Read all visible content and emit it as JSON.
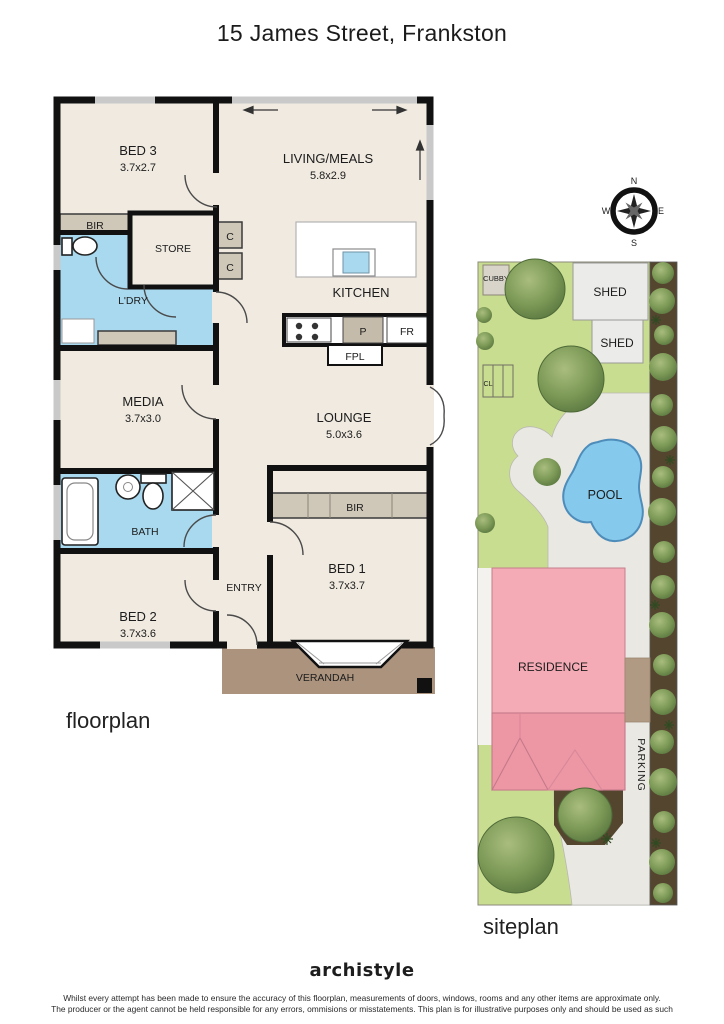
{
  "title": "15 James Street, Frankston",
  "floorplan": {
    "caption": "floorplan",
    "rooms": {
      "bed3": {
        "name": "BED 3",
        "dims": "3.7x2.7"
      },
      "living": {
        "name": "LIVING/MEALS",
        "dims": "5.8x2.9"
      },
      "bir_bed3": {
        "name": "BIR"
      },
      "store": {
        "name": "STORE"
      },
      "cupboard1": {
        "name": "C"
      },
      "cupboard2": {
        "name": "C"
      },
      "ldry": {
        "name": "L'DRY"
      },
      "kitchen": {
        "name": "KITCHEN"
      },
      "pantry": {
        "name": "P"
      },
      "fridge": {
        "name": "FR"
      },
      "fireplace": {
        "name": "FPL"
      },
      "media": {
        "name": "MEDIA",
        "dims": "3.7x3.0"
      },
      "lounge": {
        "name": "LOUNGE",
        "dims": "5.0x3.6"
      },
      "bath": {
        "name": "BATH"
      },
      "bir_bed1": {
        "name": "BIR"
      },
      "bed1": {
        "name": "BED 1",
        "dims": "3.7x3.7"
      },
      "entry": {
        "name": "ENTRY"
      },
      "bed2": {
        "name": "BED 2",
        "dims": "3.7x3.6"
      },
      "verandah": {
        "name": "VERANDAH"
      }
    }
  },
  "siteplan": {
    "caption": "siteplan",
    "labels": {
      "cubby": "CUBBY",
      "shed1": "SHED",
      "shed2": "SHED",
      "clothesline": "CL",
      "pool": "POOL",
      "residence": "RESIDENCE",
      "parking": "PARKING"
    }
  },
  "compass": {
    "north": "N",
    "east": "E",
    "south": "S",
    "west": "W"
  },
  "footer": {
    "logo": "archistyle",
    "disclaimer_line1": "Whilst every attempt has been made to ensure the accuracy of this floorplan, measurements of doors, windows, rooms and any other items are approximate only.",
    "disclaimer_line2": "The producer or the agent cannot be held responsible for any errors, ommisions or misstatements. This plan is for illustrative purposes only and should be used as such"
  },
  "colors": {
    "wall": "#111111",
    "floor": "#f0eae0",
    "wet_area": "#a8d9ee",
    "joinery_grey": "#cfc8b8",
    "verandah_brown": "#ab937e",
    "lawn_green": "#c9dd90",
    "tree_green": "#72904e",
    "pool_blue": "#85c9ec",
    "residence_pink": "#f4abb5",
    "residence_roof_pink": "#ee97a4",
    "concrete_grey": "#e9e8e3",
    "garden_bed_brown": "#54452f",
    "shed_grey": "#ebebe9",
    "deck_tan": "#b09a84"
  }
}
